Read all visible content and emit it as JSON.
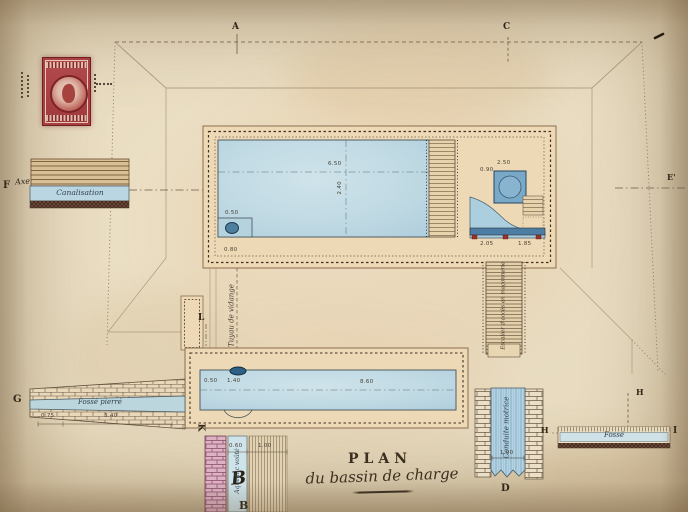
{
  "title": {
    "line1": "PLAN",
    "line2": "du bassin de charge"
  },
  "letters": {
    "a": "A",
    "c": "C",
    "e_prime": "E'",
    "f": "F",
    "axe": "Axe",
    "g": "G",
    "l": "L",
    "k": "K",
    "h_upper": "H",
    "h_lower": "H",
    "i": "I",
    "d": "D",
    "b_hand": "B",
    "b_print": "B"
  },
  "features": {
    "canalisation": "Canalisation",
    "fosse_pierre": "Fossé pierré",
    "tuyau_vidange": "Tuyau de vidange",
    "escalier": "Escalier d'accès en maçonnerie",
    "conduite_motrice": "Conduite motrice",
    "aqueduc_voute": "Aqueduc voûté",
    "fosse": "Fossé"
  },
  "dimensions": {
    "basin_length": "6.50",
    "basin_depth": "2.40",
    "notch_width": "0.50",
    "notch_level": "0.80",
    "well_offset": "2.50",
    "well_size": "0.90",
    "chamber_a": "2.05",
    "chamber_b": "1.85",
    "lower_a": "0.50",
    "lower_b": "1.40",
    "lower_length": "8.60",
    "g_a": "0.75",
    "g_b": "3.40",
    "conduite_width": "1.00",
    "aqueduc_a": "0.60",
    "aqueduc_b": "1.00"
  },
  "colors": {
    "paper": "#e7dabe",
    "paper_edge": "#c6b189",
    "ink": "#3b2f20",
    "line": "#84735c",
    "water": "#bfd9e3",
    "water_deep": "#4f7f9f",
    "wall": "#eed9b6",
    "stamp_red": "#a84043",
    "masonry_pink": "#dcb2c4",
    "section_blue": "#accfdf"
  }
}
